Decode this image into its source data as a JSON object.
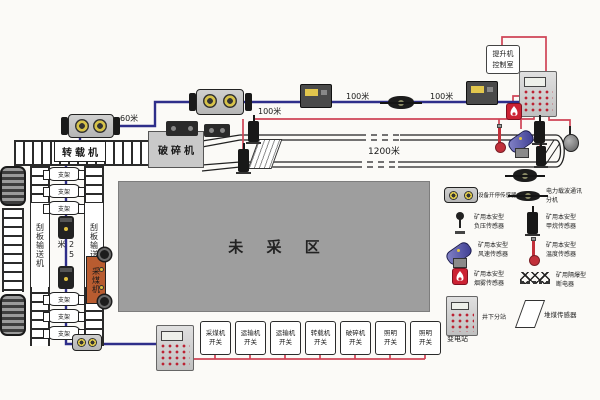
{
  "colors": {
    "cable_blue": "#2e2e8a",
    "wire_red": "#cf4456",
    "unmined_gray": "#9e9e9e",
    "shearer_orange": "#b85c30",
    "alarm_red": "#cc2233"
  },
  "surface_box": {
    "l1": "提升机",
    "l2": "控制室"
  },
  "distances": {
    "d60": "60米",
    "d100": "100米",
    "d1200": "1200米",
    "d25": "25米"
  },
  "equipment": {
    "loader": "转载机",
    "crusher": "破碎机",
    "shearer": "采煤机",
    "unmined": "未 采 区",
    "afc_conveyor": "刮板输送机",
    "support": "支架"
  },
  "switch_row": {
    "items": [
      {
        "l1": "采煤机",
        "l2": "开关"
      },
      {
        "l1": "运输机",
        "l2": "开关"
      },
      {
        "l1": "运输机",
        "l2": "开关"
      },
      {
        "l1": "转载机",
        "l2": "开关"
      },
      {
        "l1": "破碎机",
        "l2": "开关"
      },
      {
        "l1": "照明",
        "l2": "开关"
      },
      {
        "l1": "照明",
        "l2": "开关"
      }
    ],
    "train_l1": "列车",
    "train_l2": "变电站"
  },
  "legend": {
    "items": [
      {
        "name": "equipment-onoff-sensor",
        "l1": "设备开停传感器",
        "l2": ""
      },
      {
        "name": "power-line-carrier-unit",
        "l1": "电力载波通讯",
        "l2": "分机"
      },
      {
        "name": "negative-pressure-sensor",
        "l1": "矿用本安型",
        "l2": "负压传感器"
      },
      {
        "name": "methane-sensor",
        "l1": "矿用本安型",
        "l2": "甲烷传感器"
      },
      {
        "name": "wind-speed-sensor",
        "l1": "矿用本安型",
        "l2": "风速传感器"
      },
      {
        "name": "temperature-sensor",
        "l1": "矿用本安型",
        "l2": "温度传感器"
      },
      {
        "name": "smoke-sensor",
        "l1": "矿用本安型",
        "l2": "烟雾传感器"
      },
      {
        "name": "power-breaker",
        "l1": "矿用隔爆型",
        "l2": "断电器"
      },
      {
        "name": "underground-substation",
        "l1": "井下分站",
        "l2": ""
      },
      {
        "name": "coal-pile-sensor",
        "l1": "堆煤传感器",
        "l2": ""
      }
    ]
  }
}
